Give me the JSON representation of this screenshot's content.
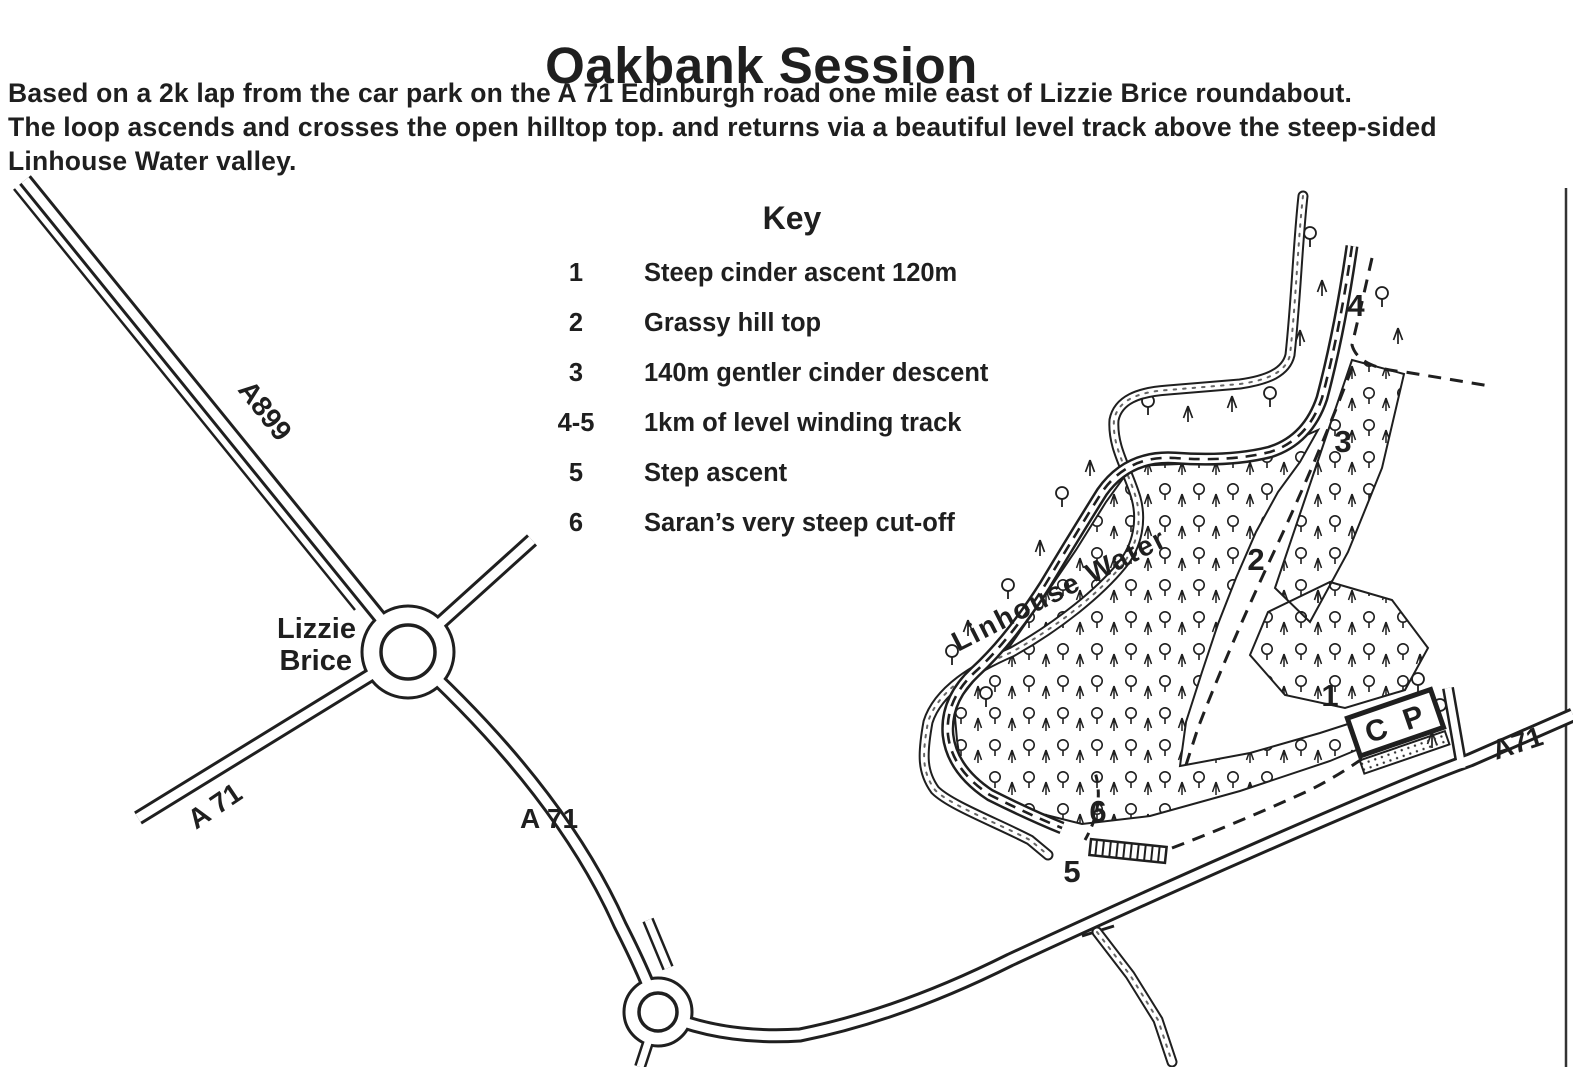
{
  "page": {
    "title": "Oakbank Session",
    "ink": "#1f1f1f",
    "paper": "#ffffff"
  },
  "intro": {
    "lines": [
      "Based on a 2k lap from the car park on the A 71 Edinburgh road one mile east of Lizzie Brice roundabout.",
      "The loop ascends and crosses the open hilltop top. and returns via a beautiful level track above the steep-sided",
      "Linhouse Water valley."
    ]
  },
  "key": {
    "heading": "Key",
    "items": [
      {
        "num": "1",
        "label": "Steep cinder ascent 120m"
      },
      {
        "num": "2",
        "label": "Grassy hill top"
      },
      {
        "num": "3",
        "label": "140m gentler cinder descent"
      },
      {
        "num": "4-5",
        "label": "1km of level winding track"
      },
      {
        "num": "5",
        "label": "Step ascent"
      },
      {
        "num": "6",
        "label": "Saran’s very steep cut-off"
      }
    ]
  },
  "map": {
    "roads": {
      "a899": "A899",
      "a71_southwest": "A 71",
      "a71_middle": "A 71",
      "a71_east": "A71"
    },
    "places": {
      "lizzie_line1": "Lizzie",
      "lizzie_line2": "Brice",
      "car_park": "C P",
      "water": "Linhouse Water"
    },
    "markers": {
      "m1": "1",
      "m2": "2",
      "m3": "3",
      "m4": "4",
      "m5": "5",
      "m6": "6"
    }
  }
}
